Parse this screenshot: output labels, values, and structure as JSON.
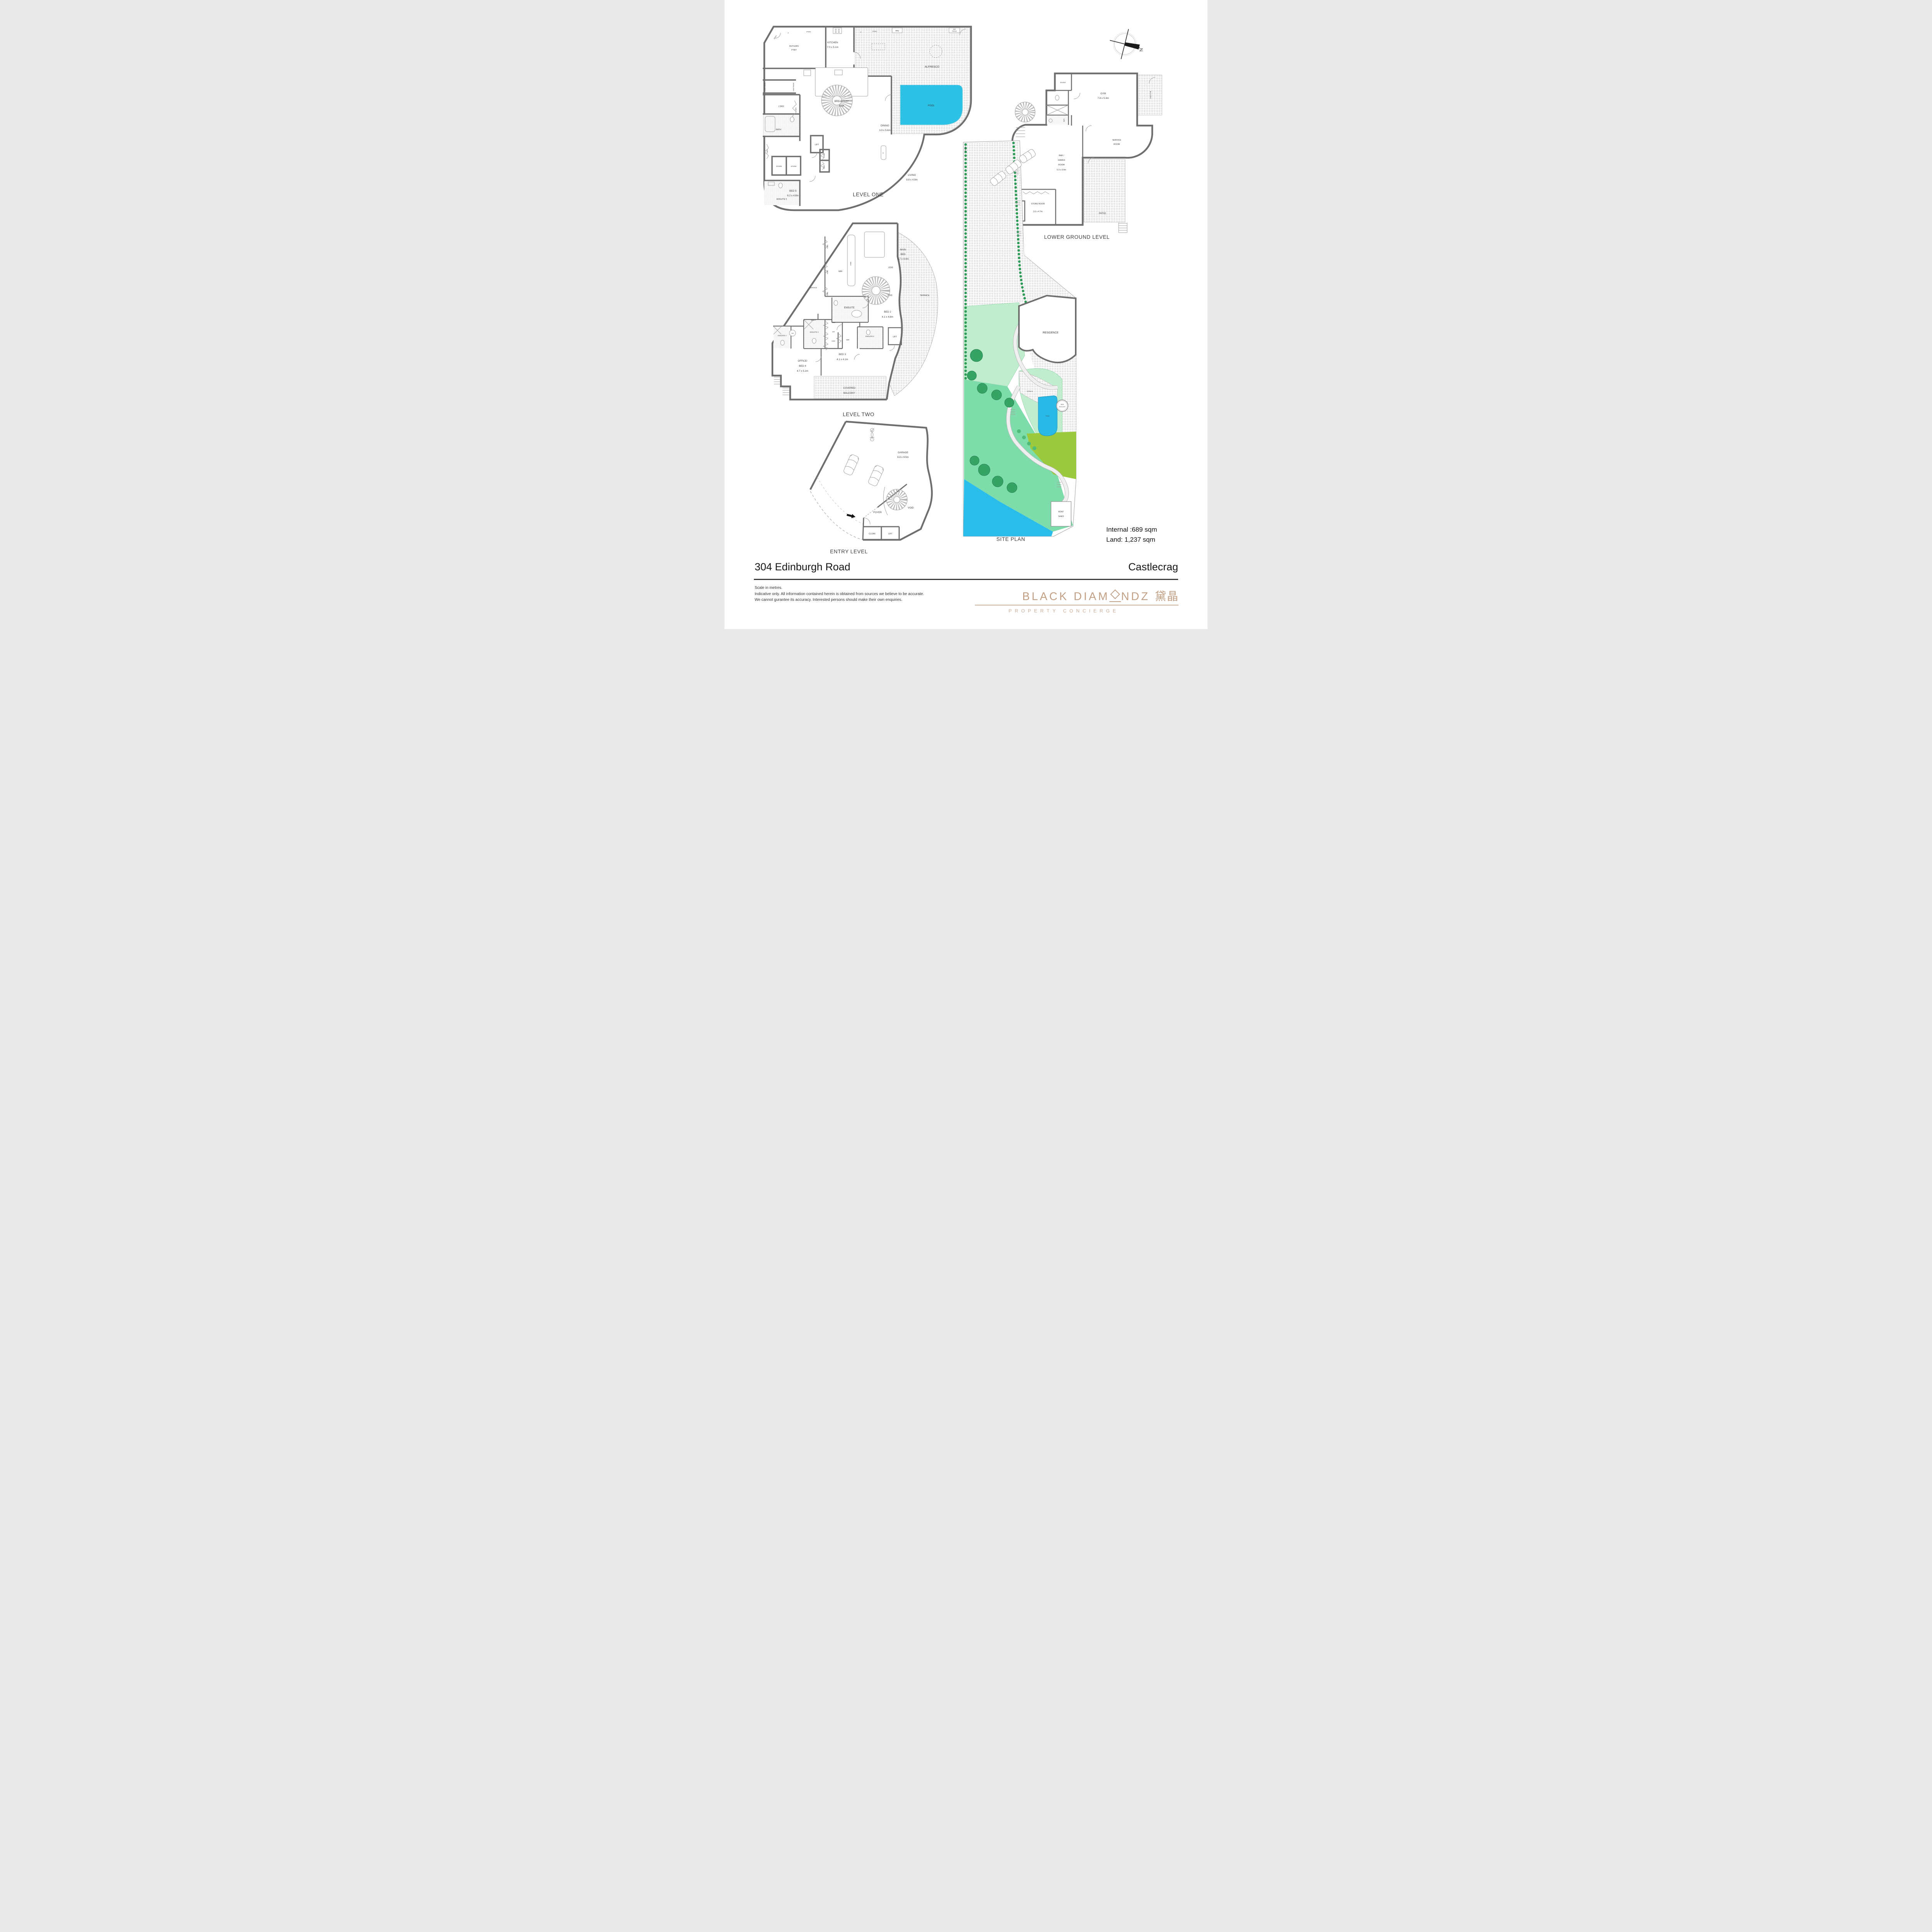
{
  "header": {
    "address": "304 Edinburgh Road",
    "suburb": "Castlecrag"
  },
  "areas": {
    "internal": "Internal :689 sqm",
    "land": "Land: 1,237 sqm"
  },
  "disclaimer": [
    "Scale in metres.",
    "Indicative only. All information contained herein is obtained from sources we believe to be accurate.",
    "We cannot gurantee its accuracy. Interested persons should make their own enquiries."
  ],
  "brand": {
    "pre": "BLACK DIAM",
    "post": "NDZ",
    "cn": "黛晶",
    "tagline": "PROPERTY CONCIERGE",
    "gold": "#c2a085"
  },
  "compass": {
    "n": "N"
  },
  "common": {
    "ptry": "PTRY",
    "f": "F",
    "robe": "ROBE",
    "store": "STORE",
    "lift": "LIFT",
    "linen": "LINEN",
    "bath": "BATH",
    "wir": "WIR",
    "void": "VOID",
    "service": "SERVICE",
    "terrace": "TERRACE",
    "pool": "POOL",
    "bbq": "BBQ",
    "ensuite": "ENSUITE"
  },
  "level_one": {
    "caption": "LEVEL ONE",
    "kitchen": "KITCHEN",
    "kitchen_dims": "7.0 x 5.1m",
    "butlers1": "BUTLERS",
    "butlers2": "PTRY",
    "breakfast1": "BREAKFAST",
    "breakfast2": "BAR",
    "dining": "DINING",
    "dining_dims": "3.9 x 5.6m",
    "alfresco": "ALFRESCO",
    "barfridge1": "BAR",
    "barfridge2": "FRIDGE",
    "ldry": "L'DRY",
    "living": "LIVING",
    "living_dims": "9.8 x 4.9m",
    "tv": "TV",
    "ensuite5": "ENSUITE 5",
    "bed5": "BED 5",
    "bed5_dims": "6.2 x 4.8m",
    "wine": "WINE FRIDGE"
  },
  "lower_ground": {
    "caption": "LOWER GROUND LEVEL",
    "sauna": "SAUNA",
    "gym": "GYM",
    "gym_dims": "7.8 x 5.4m",
    "balcony": "BALCONY",
    "service1": "SERVICE",
    "service2": "ROOM",
    "bar1": "BAR /",
    "bar2": "GAMES",
    "bar3": "ROOM",
    "bar4": "5.3 x 9.4m",
    "store_room": "STORE ROOM",
    "store_dims": "3.6 x 4.7m",
    "patio": "PATIO"
  },
  "level_two": {
    "caption": "LEVEL TWO",
    "main1": "MAIN",
    "main2": "BED",
    "main_dims": "5.7 x 4.4m",
    "bench": "BENCH",
    "hw": "HW",
    "bed2": "BED 2",
    "bed2_dims": "4.1 x 4.8m",
    "ensuite2": "ENSUITE 2",
    "ensuite3": "ENSUITE 3",
    "ensuite4": "ENSUITE 4",
    "bed3": "BED 3",
    "bed3_dims": "4.1 x 4.1m",
    "office1": "OFFICE/",
    "office2": "BED 4",
    "office_dims": "4.7 x 5.2m",
    "covered1": "COVERED",
    "covered2": "BALCONY"
  },
  "entry": {
    "caption": "ENTRY LEVEL",
    "garage": "GARAGE",
    "garage_dims": "6.8 x 9.5m",
    "foyer": "FOYER",
    "cloak": "CLOAK"
  },
  "site": {
    "caption": "SITE PLAN",
    "residence": "RESIDENCE",
    "sky1": "NEW",
    "sky2": "SKYLIGHT",
    "boat1": "BOAT",
    "boat2": "SHED"
  },
  "colors": {
    "pool": "#2cc2e6",
    "water": "#2bbde9",
    "lawn": "#9cc93e",
    "grass": "#7edcab",
    "mint": "#c0edce",
    "tree": "#35a364",
    "wall": "#6e6e6e"
  }
}
